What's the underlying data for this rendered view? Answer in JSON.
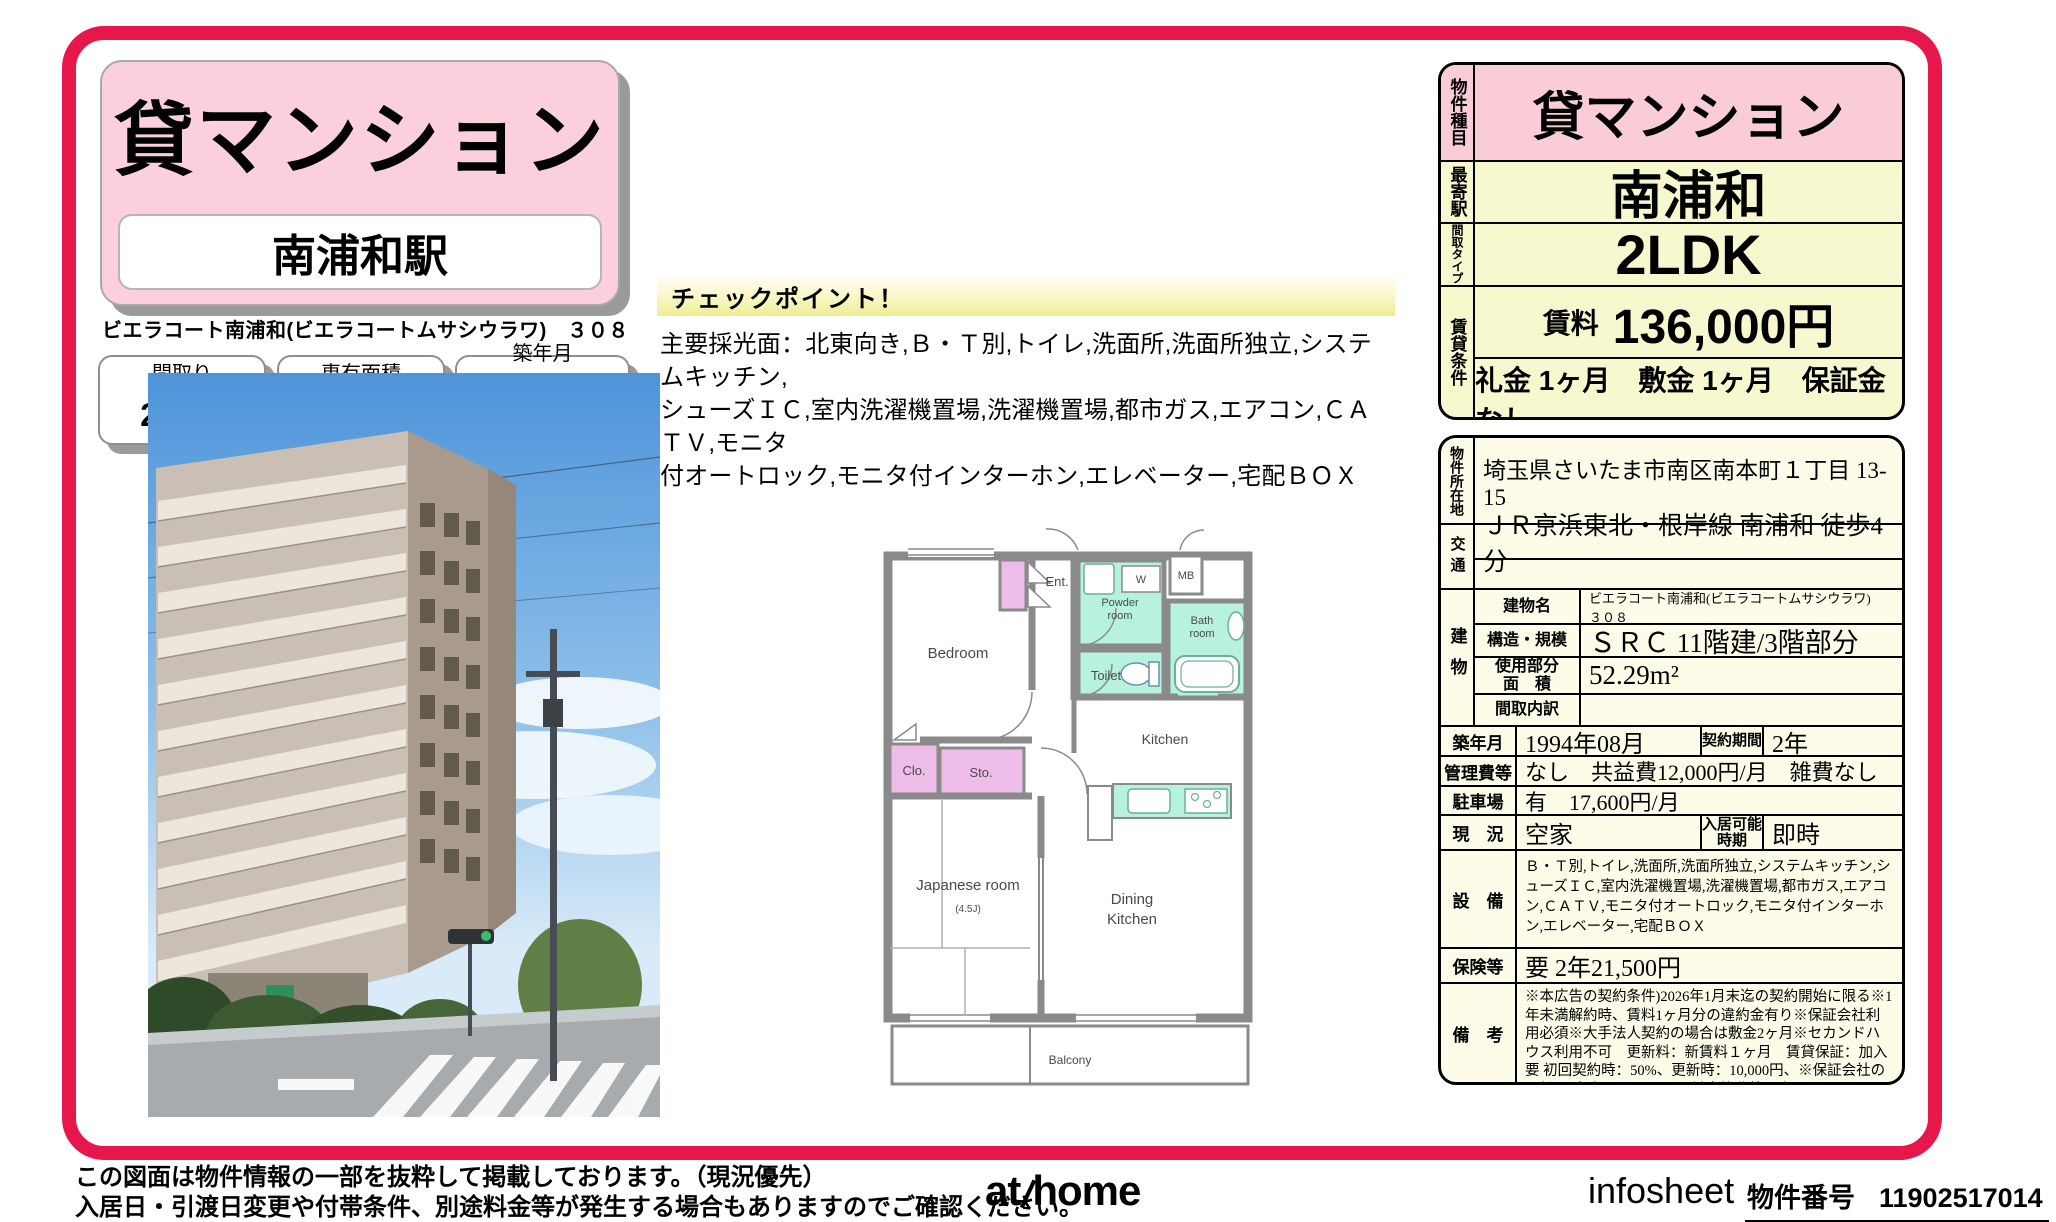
{
  "colors": {
    "accent": "#e8174b",
    "pink": "#f9ccd8",
    "cream": "#f8f8cf",
    "ivory": "#fcfce8",
    "teal": "#b7f2df",
    "closet_purple": "#eebce9"
  },
  "header": {
    "category": "貸マンション",
    "station": "南浦和駅",
    "property_name": "ビエラコート南浦和(ビエラコートムサシウラワ)　３０８"
  },
  "info_boxes": [
    {
      "label": "間取り",
      "value": "2LDK"
    },
    {
      "label": "専有面積",
      "value": "52.29m²"
    },
    {
      "label": "築年月",
      "value": "1994年08月"
    }
  ],
  "checkpoint": {
    "title": "チェックポイント！",
    "body": "主要採光面：北東向き,Ｂ・Ｔ別,トイレ,洗面所,洗面所独立,システムキッチン,\nシューズＩＣ,室内洗濯機置場,洗濯機置場,都市ガス,エアコン,ＣＡＴＶ,モニタ\n付オートロック,モニタ付インターホン,エレベーター,宅配ＢＯＸ"
  },
  "floorplan": {
    "bedroom": "Bedroom",
    "ent": "Ent.",
    "w": "W",
    "mb": "MB",
    "powder1": "Powder",
    "powder2": "room",
    "bath1": "Bath",
    "bath2": "room",
    "toilet": "Toilet",
    "kitchen": "Kitchen",
    "clo": "Clo.",
    "sto": "Sto.",
    "japanese": "Japanese room",
    "japanese_size": "(4.5J)",
    "dining1": "Dining",
    "dining2": "Kitchen",
    "balcony": "Balcony"
  },
  "summary": {
    "type_label": "物件種目",
    "type_value": "貸マンション",
    "station_label": "最寄駅",
    "station_value": "南浦和",
    "layout_label": "間取タイプ",
    "layout_value": "2LDK",
    "terms_label": "賃貸条件",
    "rent_label": "賃料",
    "rent_value": "136,000円",
    "terms_value": "礼金 1ヶ月　敷金 1ヶ月　保証金 なし"
  },
  "detail": {
    "location_label": "物件所在地",
    "location": "埼玉県さいたま市南区南本町１丁目 13-15",
    "transport_label": "交通",
    "transport1": "ＪＲ京浜東北・根岸線 南浦和 徒歩4分",
    "transport2": "",
    "building_label": "建物",
    "bname_label": "建物名",
    "bname": "ビエラコート南浦和(ビエラコートムサシウラワ)　３０８",
    "structure_label": "構造・規模",
    "structure": "ＳＲＣ 11階建/3階部分",
    "area_label": "使用部分\n面　積",
    "area": "52.29m²",
    "madori_label": "間取内訳",
    "madori": "",
    "built_label": "築年月",
    "built": "1994年08月",
    "term_label": "契約期間",
    "term": "2年",
    "fee_label": "管理費等",
    "fee": "なし　共益費12,000円/月　雑費なし",
    "parking_label": "駐車場",
    "parking": "有　17,600円/月",
    "status_label": "現　況",
    "status": "空家",
    "movein_label": "入居可能\n時期",
    "movein": "即時",
    "equip_label": "設　備",
    "equip": "Ｂ・Ｔ別,トイレ,洗面所,洗面所独立,システムキッチン,シューズＩＣ,室内洗濯機置場,洗濯機置場,都市ガス,エアコン,ＣＡＴＶ,モニタ付オートロック,モニタ付インターホン,エレベーター,宅配ＢＯＸ",
    "insurance_label": "保険等",
    "insurance": "要 2年21,500円",
    "notes_label": "備　考",
    "notes": "※本広告の契約条件)2026年1月末迄の契約開始に限る※1年未満解約時、賃料1ヶ月分の違約金有り※保証会社利用必須※大手法人契約の場合は敷金2ヶ月※セカンドハウス利用不可　更新料：新賃料１ヶ月　賃貸保証：加入要 初回契約時：50%、更新時：10,000円、※保証会社の更新は1年毎となります　鍵交換代等：有　27,500円～"
  },
  "footer": {
    "notes": "この図面は物件情報の一部を抜粋して掲載しております。（現況優先）\n入居日・引渡日変更や付帯条件、別途料金等が発生する場合もありますのでご確認ください。",
    "logo_at": "at",
    "logo_home": "home",
    "infosheet": "infosheet",
    "property_no_label": "物件番号",
    "property_no": "11902517014"
  }
}
